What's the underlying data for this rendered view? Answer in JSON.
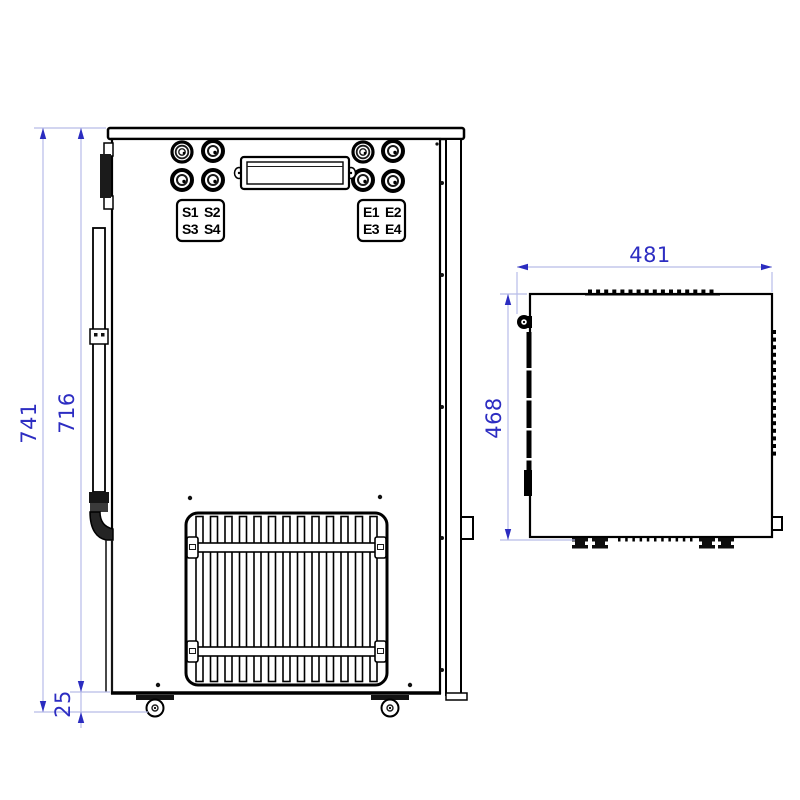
{
  "drawing": {
    "rear_view": {
      "ports_left": [
        "S1",
        "S2",
        "S3",
        "S4"
      ],
      "ports_right": [
        "E1",
        "E2",
        "E3",
        "E4"
      ],
      "dimensions": {
        "overall_height": "741",
        "body_height": "716",
        "base_clearance": "25"
      }
    },
    "side_view": {
      "dimensions": {
        "overall_depth": "481",
        "body_depth": "468"
      }
    },
    "colors": {
      "outline": "#000000",
      "dimension_line": "#b7bce8",
      "dimension_accent": "#2d2dc2",
      "background": "#ffffff"
    }
  }
}
